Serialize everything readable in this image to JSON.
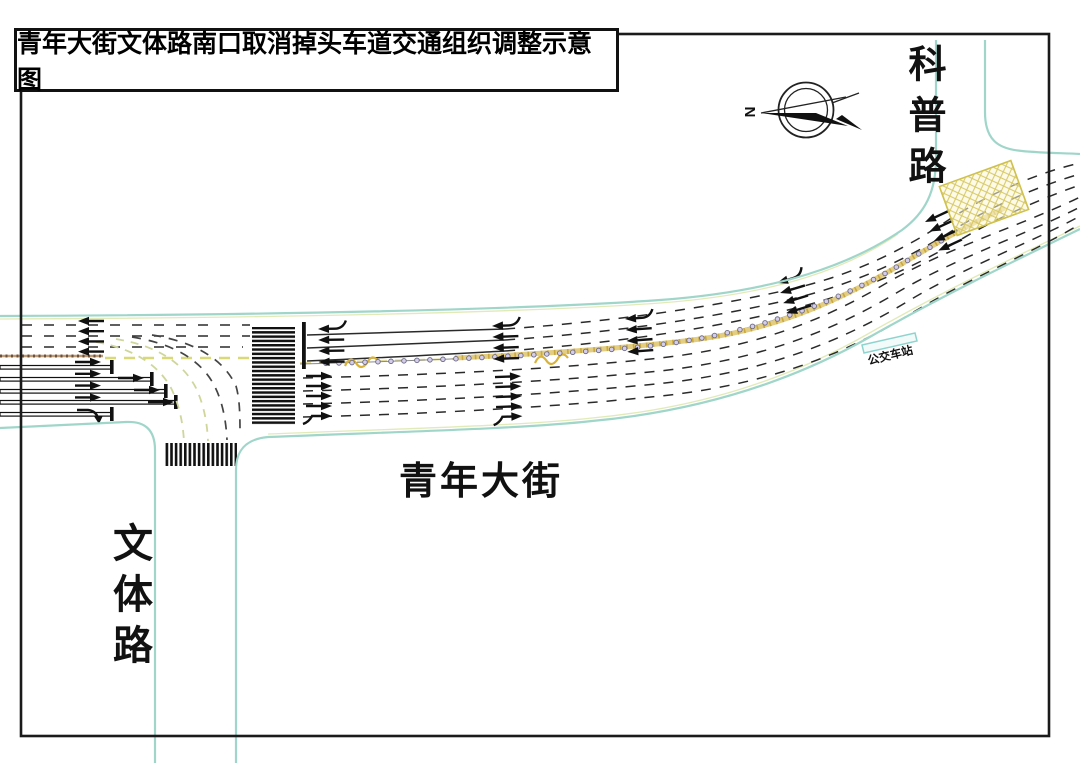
{
  "title": "青年大街文体路南口取消掉头车道交通组织调整示意图",
  "compass": {
    "label": "N"
  },
  "roads": {
    "main": {
      "label": "青年大街"
    },
    "south": {
      "label": "文体路"
    },
    "north": {
      "label": "科普路"
    }
  },
  "bus_stop": {
    "label": "公交车站"
  },
  "colors": {
    "road_edge": "#9fd6c9",
    "edge_accent": "#e2eab8",
    "center_yellow": "#e3cd82",
    "center_yellow_dark": "#c9a83e",
    "mesh_zone": "#cfc04a",
    "brown_median": "#bb9a76",
    "marking": "#222222"
  },
  "markings": {
    "fence": {
      "x_start": 316,
      "x_end": 948,
      "spacing": 13
    },
    "arrow_clusters": [
      {
        "x": 78,
        "y": 321,
        "angle": 0,
        "n": 4,
        "gap": 10.2,
        "dir": "left",
        "curl_first": false
      },
      {
        "x": 318,
        "y": 329,
        "angle": -1,
        "n": 4,
        "gap": 11,
        "dir": "left",
        "curl_first": true
      },
      {
        "x": 492,
        "y": 326,
        "angle": -2,
        "n": 4,
        "gap": 11,
        "dir": "left",
        "curl_first": true
      },
      {
        "x": 625,
        "y": 319,
        "angle": -4,
        "n": 4,
        "gap": 11,
        "dir": "left",
        "curl_first": true
      },
      {
        "x": 777,
        "y": 283,
        "angle": -17,
        "n": 4,
        "gap": 10.5,
        "dir": "left",
        "curl_first": true
      },
      {
        "x": 925,
        "y": 222,
        "angle": -25,
        "n": 4,
        "gap": 10.5,
        "dir": "left",
        "curl_first": false
      },
      {
        "x": 77,
        "y": 362,
        "angle": 0,
        "n": 4,
        "gap": 11.8,
        "dir": "right",
        "curl_last": false
      },
      {
        "x": 308,
        "y": 376,
        "angle": 0,
        "n": 5,
        "gap": 10,
        "dir": "right",
        "curl_last": true
      },
      {
        "x": 497,
        "y": 377,
        "angle": -2,
        "n": 5,
        "gap": 10,
        "dir": "right",
        "curl_last": true
      }
    ],
    "extra_arrows": [
      {
        "x": 120,
        "y": 378
      },
      {
        "x": 136,
        "y": 390
      },
      {
        "x": 150,
        "y": 402
      }
    ]
  }
}
